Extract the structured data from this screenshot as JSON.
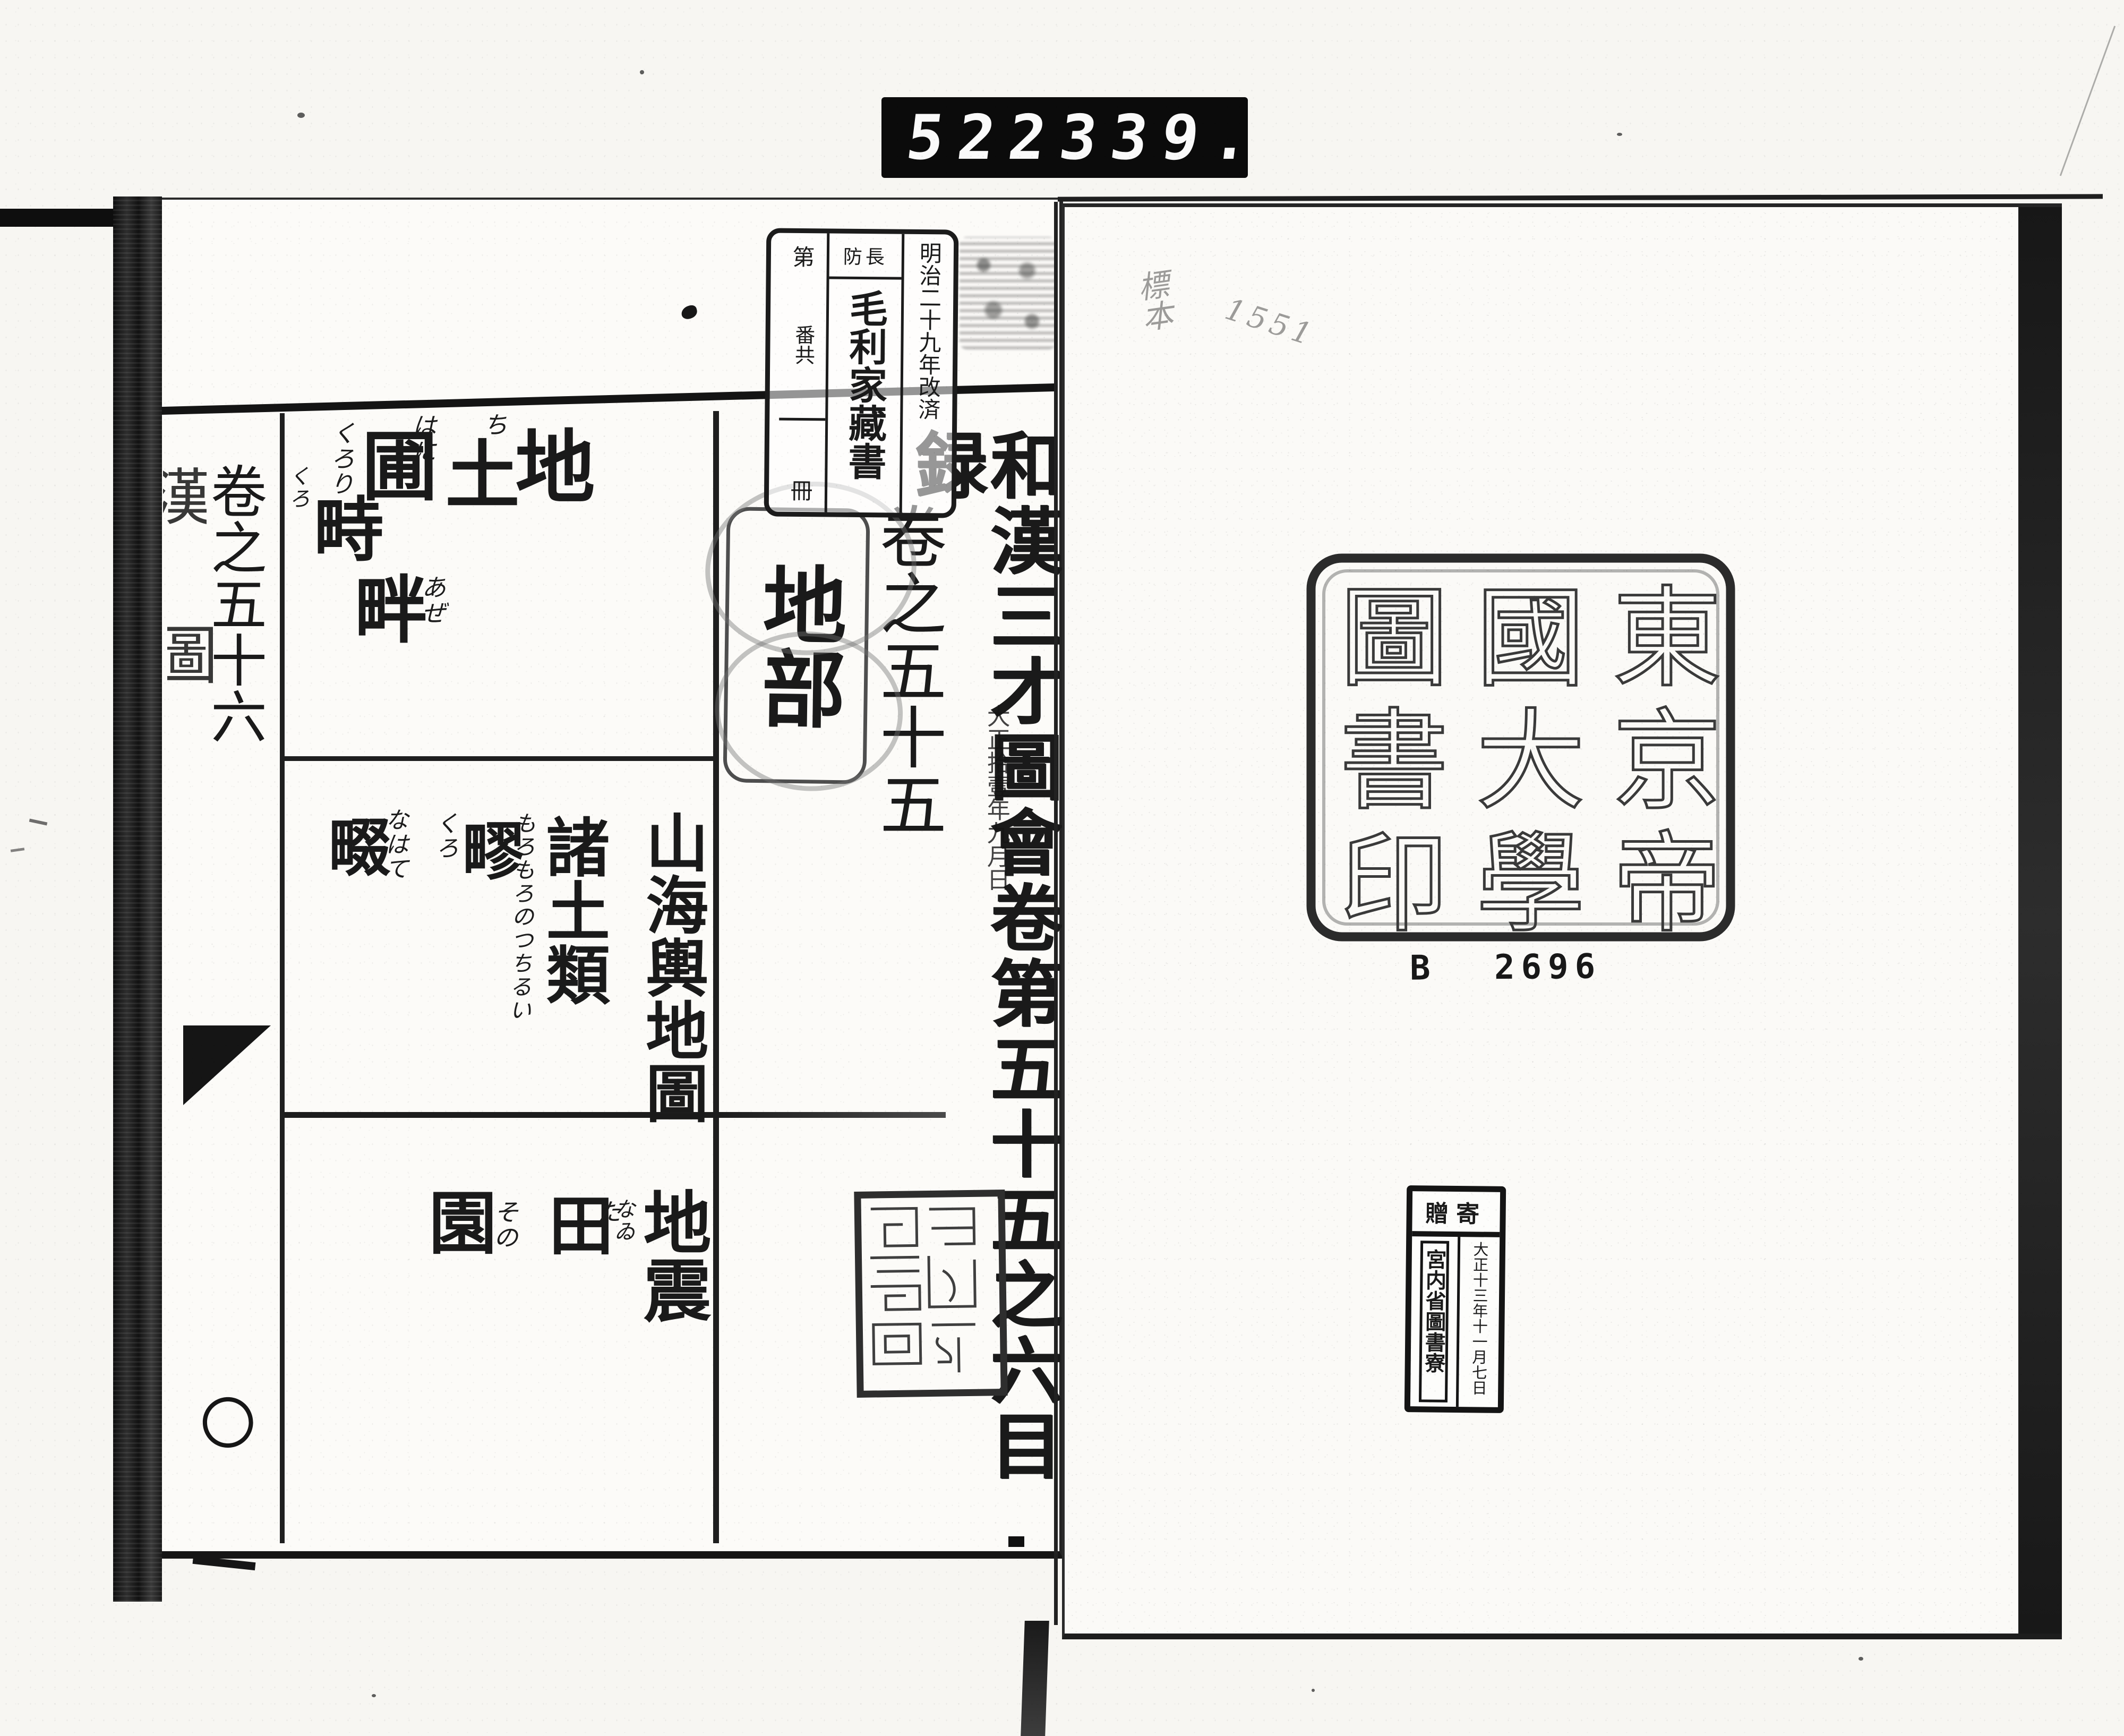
{
  "appearance": {
    "paper": "#fbfaf7",
    "ink": "#1a1a1a",
    "counter_bg": "#0b0b0b",
    "counter_digits": "#fafafa"
  },
  "counter": {
    "left_digits": "522",
    "right_digits": "339."
  },
  "left_page": {
    "spine_fragments": {
      "upper": "漢",
      "lower": "圖",
      "ring": "〇",
      "dash": "一"
    },
    "volume_56_label": "卷之五十六",
    "ownership_stamp": {
      "right_column": "明治二十九年改済",
      "header": "防長",
      "title": "毛利家藏書",
      "left_top": "第",
      "left_middle": "番共",
      "left_bottom": "冊"
    },
    "volume_55_label": "卷之五十五",
    "section_label": "地部",
    "main_title": "和漢三才圖會卷第五十五之六目録",
    "date_stamp": "大正拾壹年九月日",
    "row1": [
      {
        "kanji": "地",
        "kana": "ち"
      },
      {
        "kanji": "土",
        "kana": "はに"
      },
      {
        "kanji": "圃",
        "kana": "くろり"
      },
      {
        "kanji": "畤",
        "kana": "くろ"
      },
      {
        "kanji": "畔",
        "kana": "あぜ"
      }
    ],
    "row2": [
      {
        "kanji": "山海輿地圖",
        "kana": ""
      },
      {
        "kanji": "諸土類",
        "kana": "もろもろのつちるい"
      },
      {
        "kanji": "疁",
        "kana": "くろ"
      },
      {
        "kanji": "畷",
        "kana": "なはて"
      }
    ],
    "row3": [
      {
        "kanji": "地震",
        "kana": "なゐ"
      },
      {
        "kanji": "田",
        "kana": "た"
      },
      {
        "kanji": "園",
        "kana": "その"
      }
    ]
  },
  "right_page": {
    "handwriting": {
      "label": "標本",
      "number": "1551"
    },
    "library_seal": {
      "col_right": "東京帝",
      "col_middle": "國大學",
      "col_left": "圖書印"
    },
    "accession_number": "B 2696",
    "donation_stamp": {
      "header": "贈寄",
      "date": "大正十三年十一月七日",
      "organization": "宮内省圖書寮"
    }
  }
}
